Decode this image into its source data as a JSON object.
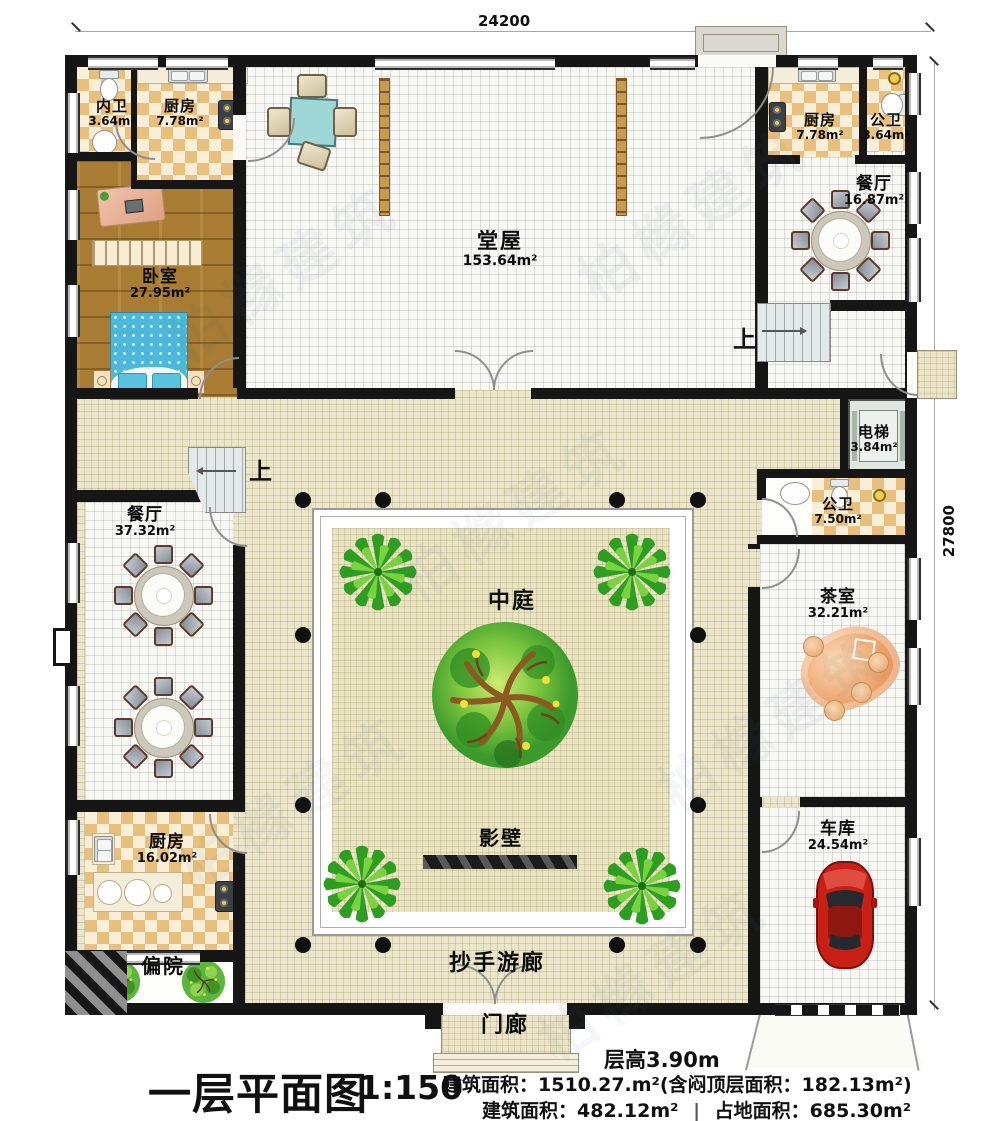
{
  "watermark": {
    "text": "柏橼建筑"
  },
  "dimensions": {
    "top": "24200",
    "right": "27800"
  },
  "stairs": {
    "up": "上"
  },
  "rooms": {
    "inner_bath": {
      "name": "内卫",
      "area": "3.64m²"
    },
    "kitchen_tl": {
      "name": "厨房",
      "area": "7.78m²"
    },
    "bedroom": {
      "name": "卧室",
      "area": "27.95m²"
    },
    "hall": {
      "name": "堂屋",
      "area": "153.64m²"
    },
    "kitchen_tr": {
      "name": "厨房",
      "area": "7.78m²"
    },
    "bath_tr": {
      "name": "公卫",
      "area": "3.64m²"
    },
    "dining_tr": {
      "name": "餐厅",
      "area": "16.87m²"
    },
    "elevator": {
      "name": "电梯",
      "area": "3.84m²"
    },
    "bath_r": {
      "name": "公卫",
      "area": "7.50m²"
    },
    "tea_room": {
      "name": "茶室",
      "area": "32.21m²"
    },
    "garage": {
      "name": "车库",
      "area": "24.54m²"
    },
    "dining_l": {
      "name": "餐厅",
      "area": "37.32m²"
    },
    "kitchen_bl": {
      "name": "厨房",
      "area": "16.02m²"
    },
    "side_yard": {
      "name": "偏院"
    },
    "courtyard": {
      "name": "中庭"
    },
    "screen_wall": {
      "name": "影壁"
    },
    "veranda": {
      "name": "抄手游廊"
    },
    "porch": {
      "name": "门廊"
    }
  },
  "footer": {
    "plan_title": "一层平面图",
    "scale": "1:150",
    "floor_height": "层高3.90m",
    "area_line1": "建筑面积：1510.27.m²(含闷顶层面积：182.13m²)",
    "area_line2_a": "建筑面积：482.12m²",
    "area_line2_divider": "|",
    "area_line2_b": "占地面积：685.30m²"
  }
}
